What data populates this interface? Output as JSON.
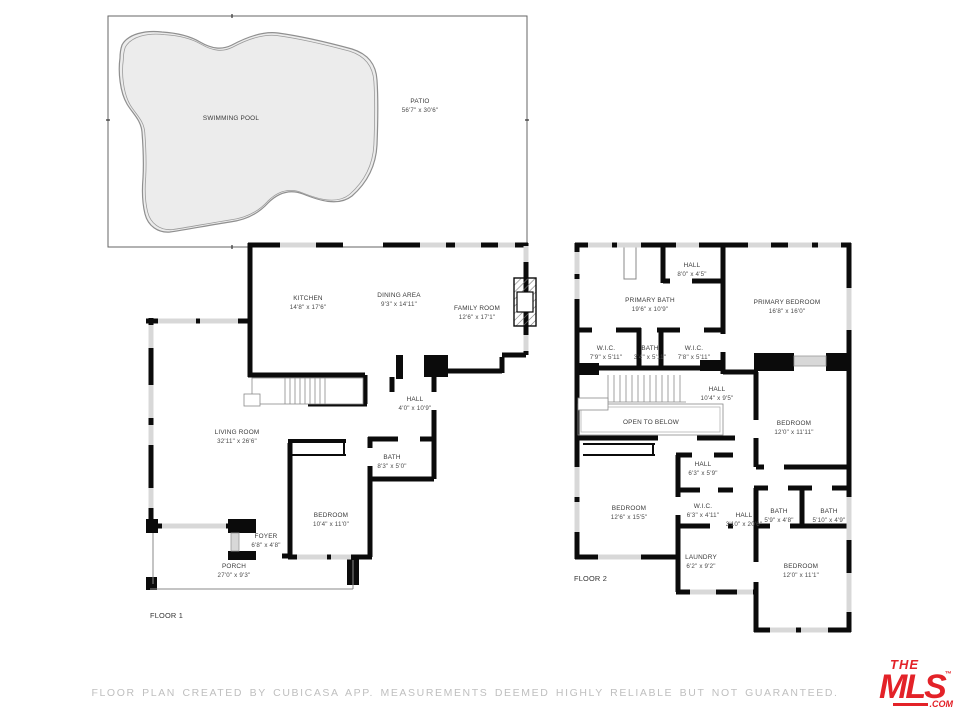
{
  "outdoor": {
    "pool": {
      "name": "SWIMMING POOL"
    },
    "patio": {
      "name": "PATIO",
      "dims": "56'7\" x 30'6\""
    }
  },
  "floor1": {
    "label": "FLOOR 1",
    "rooms": [
      {
        "name": "KITCHEN",
        "dims": "14'8\" x 17'6\""
      },
      {
        "name": "DINING AREA",
        "dims": "9'3\" x 14'11\""
      },
      {
        "name": "FAMILY ROOM",
        "dims": "12'6\" x 17'1\""
      },
      {
        "name": "HALL",
        "dims": "4'0\" x 10'9\""
      },
      {
        "name": "LIVING ROOM",
        "dims": "32'11\" x 26'6\""
      },
      {
        "name": "BATH",
        "dims": "8'3\" x 5'0\""
      },
      {
        "name": "BEDROOM",
        "dims": "10'4\" x 11'0\""
      },
      {
        "name": "FOYER",
        "dims": "6'8\" x 4'8\""
      },
      {
        "name": "PORCH",
        "dims": "27'0\" x 9'3\""
      }
    ]
  },
  "floor2": {
    "label": "FLOOR 2",
    "rooms": [
      {
        "name": "HALL",
        "dims": "8'0\" x 4'5\""
      },
      {
        "name": "PRIMARY BATH",
        "dims": "19'6\" x 10'9\""
      },
      {
        "name": "PRIMARY BEDROOM",
        "dims": "16'8\" x 16'0\""
      },
      {
        "name": "W.I.C.",
        "dims": "7'9\" x 5'11\""
      },
      {
        "name": "BATH",
        "dims": "3'4\" x 5'11\""
      },
      {
        "name": "W.I.C.",
        "dims": "7'8\" x 5'11\""
      },
      {
        "name": "HALL",
        "dims": "10'4\" x 9'5\""
      },
      {
        "name": "OPEN TO BELOW",
        "dims": ""
      },
      {
        "name": "BEDROOM",
        "dims": "12'0\" x 11'11\""
      },
      {
        "name": "HALL",
        "dims": "6'3\" x 5'9\""
      },
      {
        "name": "BEDROOM",
        "dims": "12'6\" x 15'5\""
      },
      {
        "name": "W.I.C.",
        "dims": "6'3\" x 4'11\""
      },
      {
        "name": "HALL",
        "dims": "3'10\" x 20'6\""
      },
      {
        "name": "BATH",
        "dims": "5'9\" x 4'8\""
      },
      {
        "name": "BATH",
        "dims": "5'10\" x 4'9\""
      },
      {
        "name": "LAUNDRY",
        "dims": "6'2\" x 9'2\""
      },
      {
        "name": "BEDROOM",
        "dims": "12'0\" x 11'1\""
      }
    ]
  },
  "footer": {
    "disclaimer": "FLOOR PLAN CREATED BY CUBICASA APP. MEASUREMENTS DEEMED HIGHLY RELIABLE BUT NOT GUARANTEED."
  },
  "logo": {
    "line1": "THE",
    "line2": "MLS",
    "trademark": "™",
    "suffix": ".COM"
  },
  "colors": {
    "wall": "#0b0b0b",
    "window": "#d8d8d8",
    "pool_fill": "#ececec",
    "accent_red": "#e32228",
    "footer_text": "#bfbfbf"
  }
}
